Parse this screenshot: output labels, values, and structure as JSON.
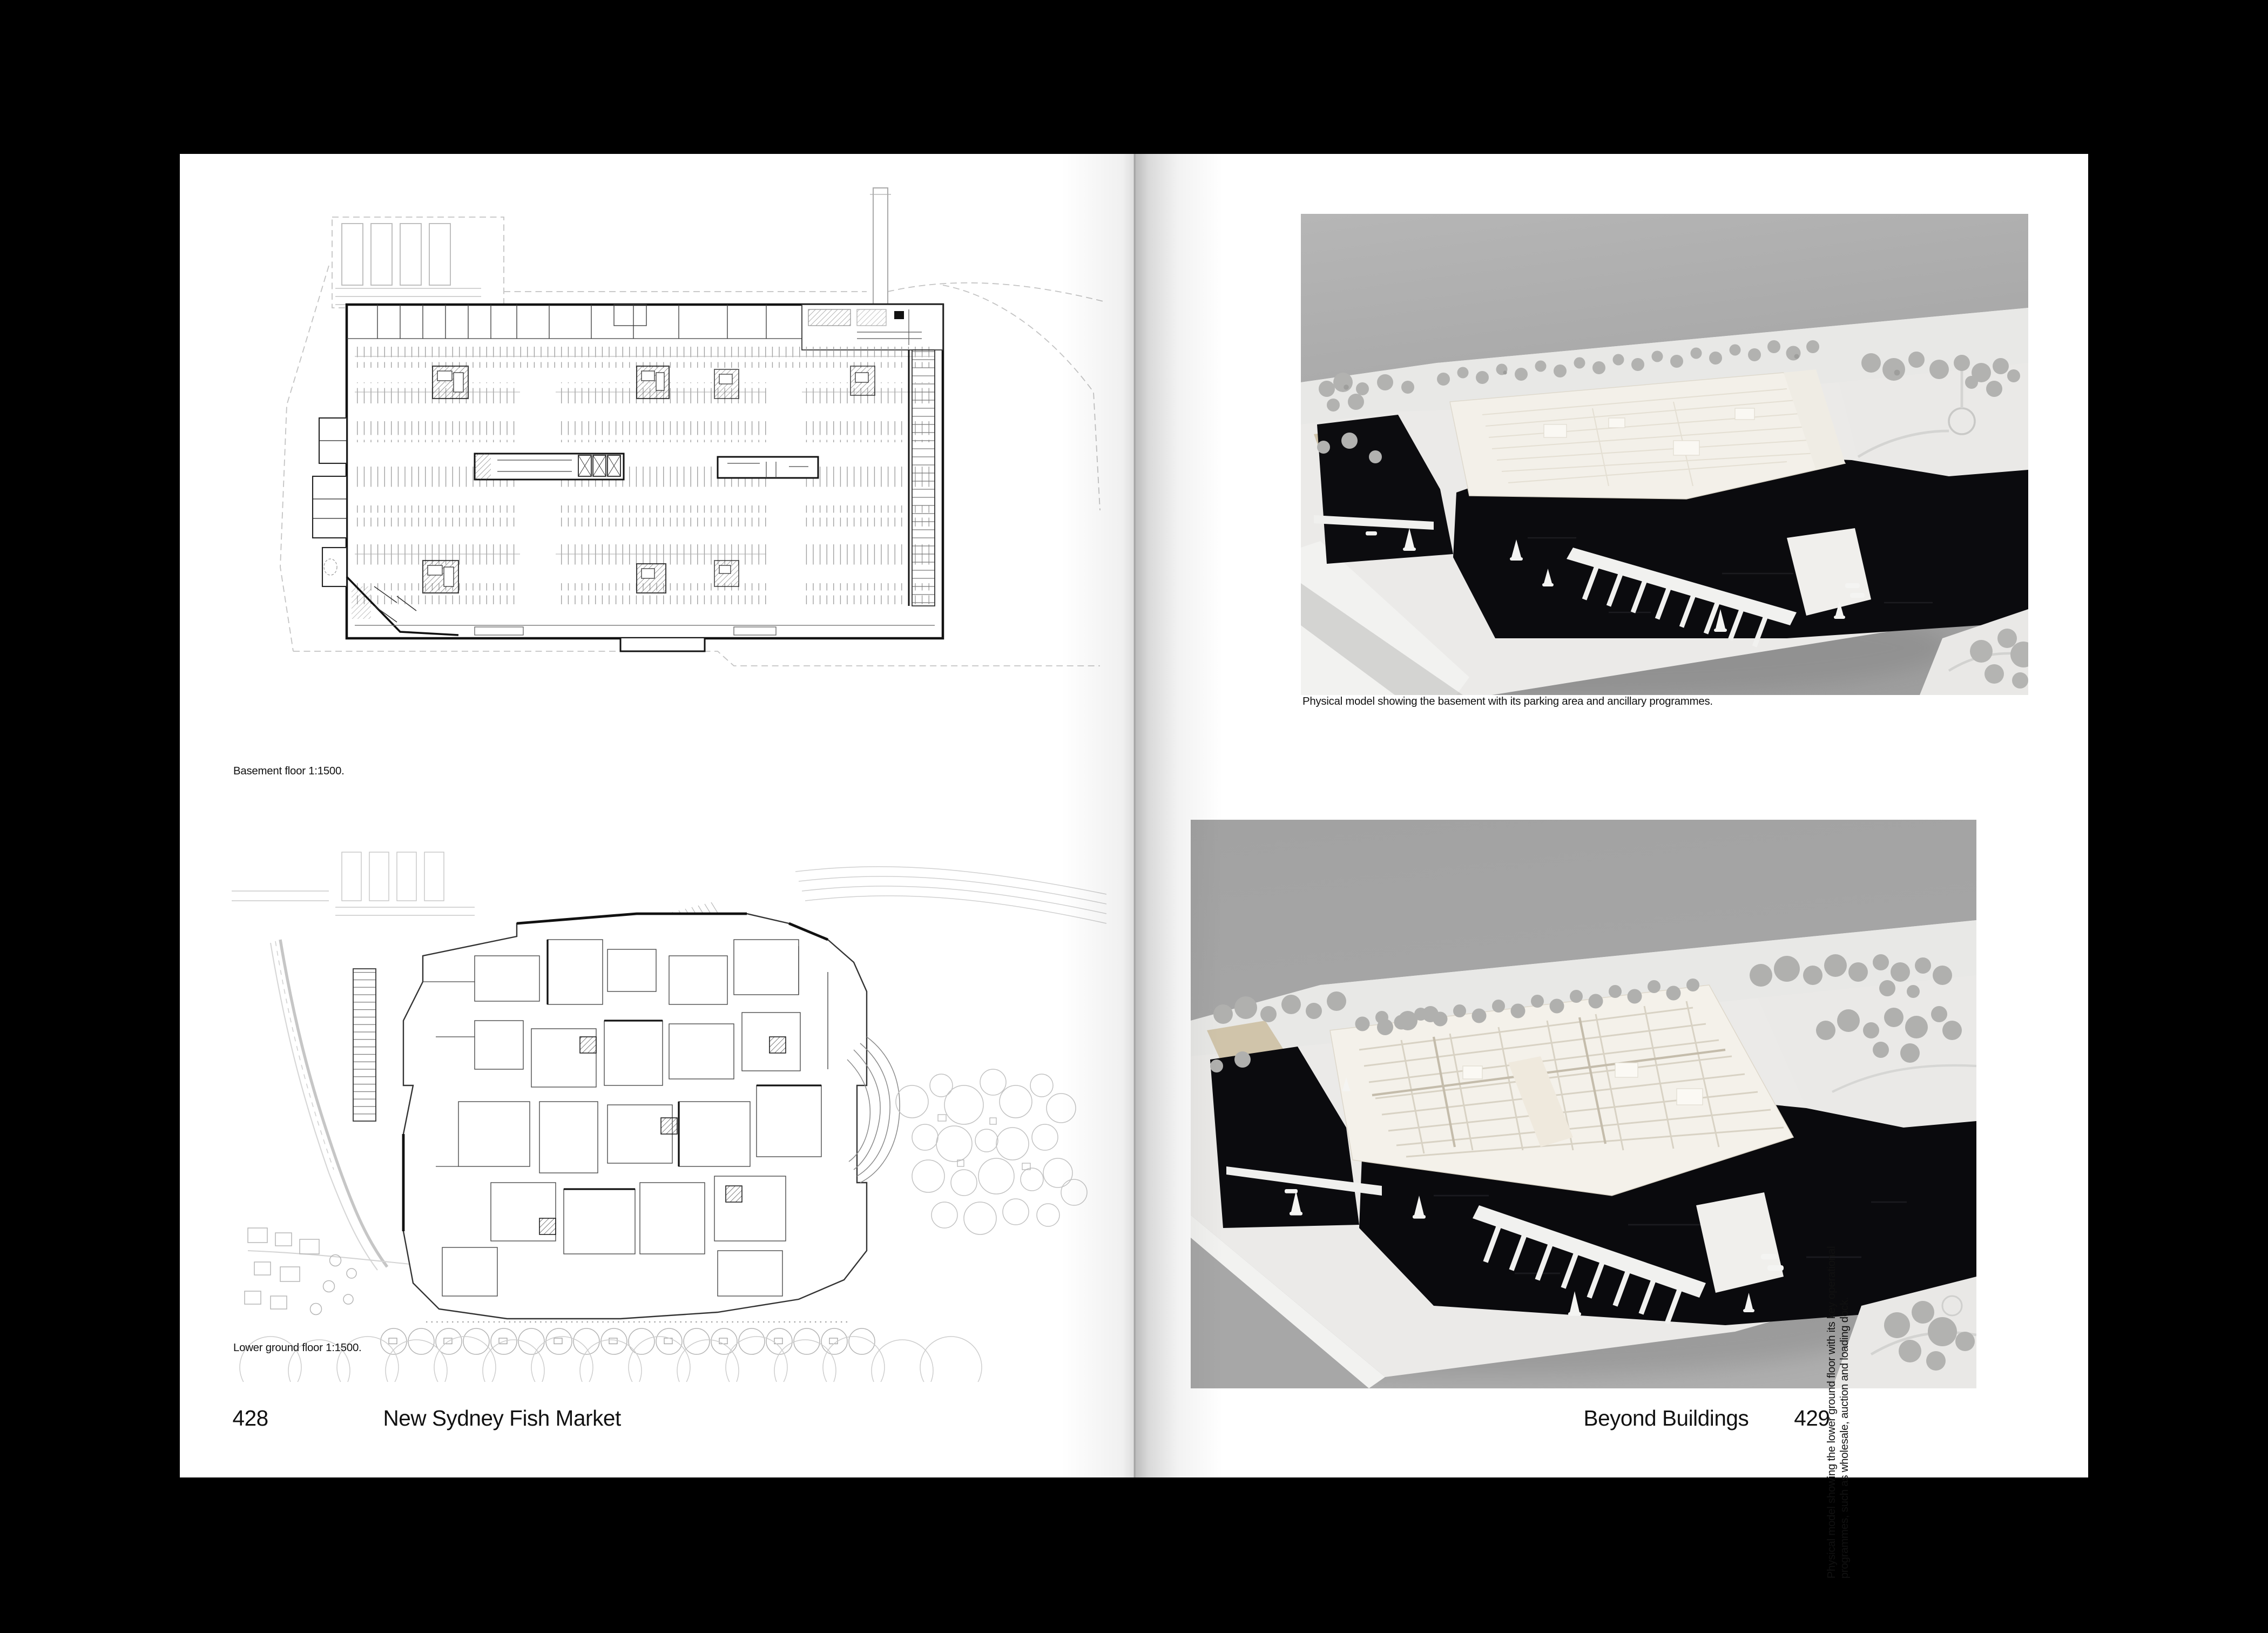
{
  "book": {
    "left_page": {
      "figures": [
        {
          "name": "basement-floor-plan",
          "caption": "Basement floor 1:1500."
        },
        {
          "name": "lower-ground-floor-plan",
          "caption": "Lower ground floor 1:1500."
        }
      ],
      "footer": {
        "page_number": "428",
        "title": "New Sydney Fish Market"
      }
    },
    "right_page": {
      "figures": [
        {
          "name": "model-photo-basement",
          "caption": "Physical model showing the basement with its parking area and ancillary programmes."
        },
        {
          "name": "model-photo-lower-ground",
          "caption": "Physical model showing the lower ground floor with its key operational programmes, such as wholesale, auction and loading dock."
        }
      ],
      "footer": {
        "title": "Beyond Buildings",
        "page_number": "429"
      }
    },
    "colors": {
      "backdrop": "#000000",
      "paper": "#ffffff",
      "photo_background": "#a6a6a6",
      "model_water": "#0b0b0e",
      "model_white": "#eceae8",
      "text": "#111111"
    }
  }
}
